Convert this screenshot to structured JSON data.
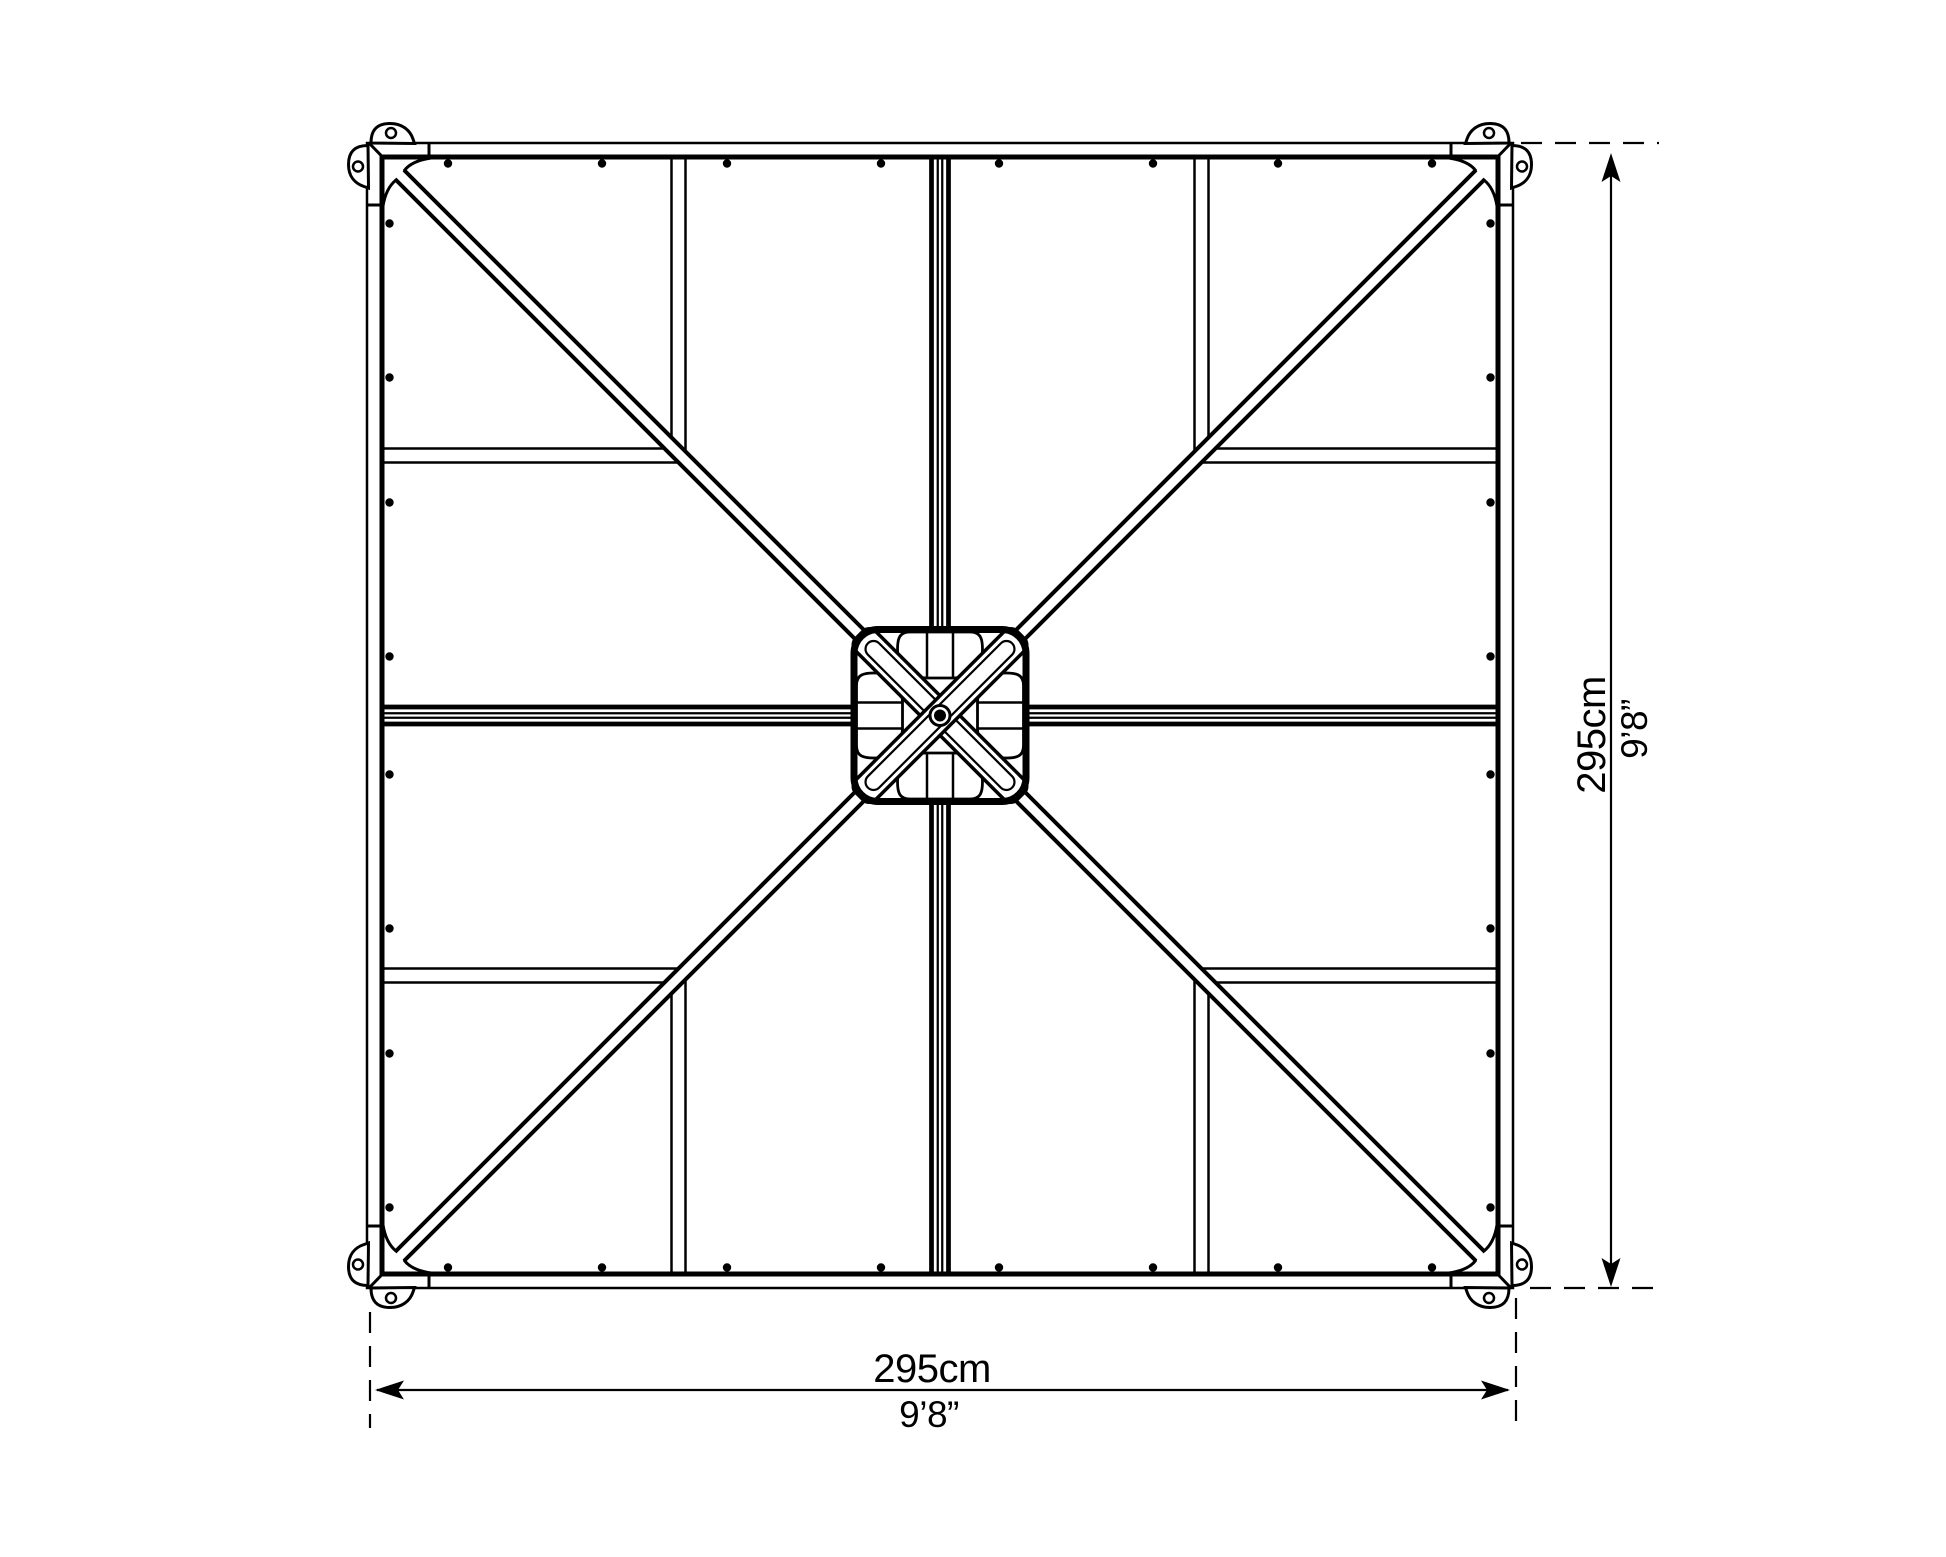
{
  "dimensions": {
    "bottom": {
      "metric": "295cm",
      "imperial": "9’8”"
    },
    "right": {
      "metric": "295cm",
      "imperial": "9’8”"
    }
  },
  "colors": {
    "ink": "#000000",
    "paper": "#ffffff"
  }
}
